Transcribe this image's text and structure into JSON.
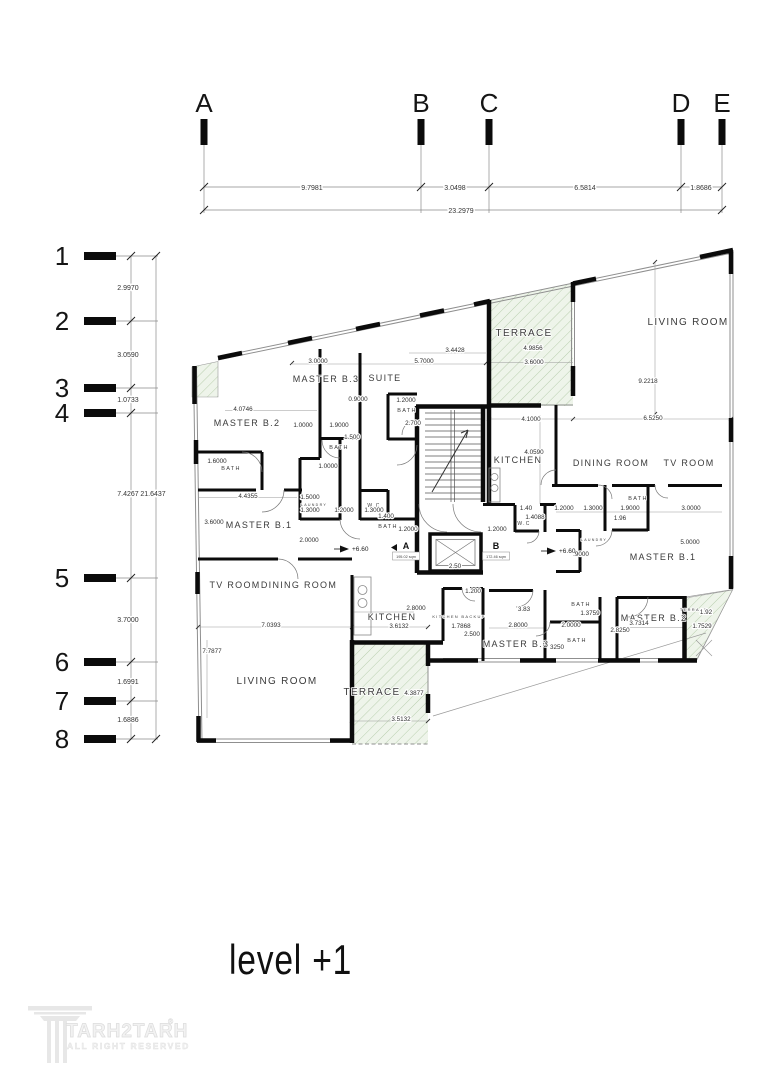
{
  "title": {
    "text": "level +1"
  },
  "logo": {
    "name": "TARH2TARH",
    "registered": "®",
    "tagline": "ALL RIGHT RESERVED"
  },
  "colors": {
    "wall": "#0b0b0b",
    "dim_text": "#2e2e2e",
    "hatch_fill": "#eef4ea",
    "hatch_line": "#b9cfae",
    "window_line": "#8f8f8f",
    "logo_gray": "#ececec"
  },
  "grid": {
    "top": {
      "columns": [
        {
          "label": "A",
          "x": 204
        },
        {
          "label": "B",
          "x": 421
        },
        {
          "label": "C",
          "x": 489
        },
        {
          "label": "D",
          "x": 681
        },
        {
          "label": "E",
          "x": 722
        }
      ],
      "segment_dims": [
        {
          "text": "9.7981",
          "x": 312
        },
        {
          "text": "3.0498",
          "x": 455
        },
        {
          "text": "6.5814",
          "x": 585
        },
        {
          "text": "1.8686",
          "x": 701
        }
      ],
      "overall_dim": {
        "text": "23.2979",
        "x": 461
      }
    },
    "left": {
      "rows": [
        {
          "label": "1",
          "y": 256
        },
        {
          "label": "2",
          "y": 321
        },
        {
          "label": "3",
          "y": 388
        },
        {
          "label": "4",
          "y": 413
        },
        {
          "label": "5",
          "y": 578
        },
        {
          "label": "6",
          "y": 662
        },
        {
          "label": "7",
          "y": 701
        },
        {
          "label": "8",
          "y": 739
        }
      ],
      "segment_dims": [
        {
          "text": "2.9970",
          "y": 288
        },
        {
          "text": "3.0590",
          "y": 355
        },
        {
          "text": "1.0733",
          "y": 400
        },
        {
          "text": "7.4267",
          "y": 494
        },
        {
          "text": "3.7000",
          "y": 620
        },
        {
          "text": "1.6991",
          "y": 682
        },
        {
          "text": "1.6886",
          "y": 720
        }
      ],
      "overall_dim": {
        "text": "21.6437",
        "y": 494
      }
    }
  },
  "plan": {
    "rooms": [
      {
        "name": "room-terrace-top",
        "text": "TERRACE",
        "x": 524,
        "y": 336,
        "fs": 10
      },
      {
        "name": "room-living-top-right",
        "text": "LIVING ROOM",
        "x": 688,
        "y": 325,
        "fs": 10
      },
      {
        "name": "room-master-b3-left",
        "text": "MASTER B.3",
        "x": 326,
        "y": 382,
        "fs": 9
      },
      {
        "name": "room-suite",
        "text": "SUITE",
        "x": 385,
        "y": 381,
        "fs": 9
      },
      {
        "name": "room-master-b2-left",
        "text": "MASTER B.2",
        "x": 247,
        "y": 426,
        "fs": 9
      },
      {
        "name": "room-bath-suite",
        "text": "BATH",
        "x": 407,
        "y": 412,
        "fs": 5.5
      },
      {
        "name": "room-bath-mid",
        "text": "BATH",
        "x": 339,
        "y": 449,
        "fs": 5.5
      },
      {
        "name": "room-bath-left",
        "text": "BATH",
        "x": 231,
        "y": 470,
        "fs": 5.5
      },
      {
        "name": "room-bath-core",
        "text": "BATH",
        "x": 388,
        "y": 528,
        "fs": 5.5
      },
      {
        "name": "room-master-b1-left",
        "text": "MASTER B.1",
        "x": 259,
        "y": 528,
        "fs": 9
      },
      {
        "name": "room-wc-left",
        "text": "W.C",
        "x": 374,
        "y": 507,
        "fs": 5
      },
      {
        "name": "room-laundry-left",
        "text": "LAUNDRY",
        "x": 314,
        "y": 506,
        "fs": 3.6
      },
      {
        "name": "room-kitchen-right",
        "text": "KITCHEN",
        "x": 518,
        "y": 463,
        "fs": 9
      },
      {
        "name": "room-dining-right",
        "text": "DINING ROOM",
        "x": 611,
        "y": 466,
        "fs": 9
      },
      {
        "name": "room-tv-right",
        "text": "TV ROOM",
        "x": 689,
        "y": 466,
        "fs": 9
      },
      {
        "name": "room-bath-right-top",
        "text": "BATH",
        "x": 638,
        "y": 500,
        "fs": 5.5
      },
      {
        "name": "room-wc-right",
        "text": "W.C",
        "x": 524,
        "y": 525,
        "fs": 5
      },
      {
        "name": "room-laundry-right",
        "text": "LAUNDRY",
        "x": 594,
        "y": 541,
        "fs": 3.6
      },
      {
        "name": "room-master-b1-right",
        "text": "MASTER B.1",
        "x": 663,
        "y": 560,
        "fs": 9
      },
      {
        "name": "room-tv-left",
        "text": "TV ROOM",
        "x": 235,
        "y": 588,
        "fs": 9
      },
      {
        "name": "room-dining-left",
        "text": "DINING ROOM",
        "x": 299,
        "y": 588,
        "fs": 9
      },
      {
        "name": "room-living-bottom-left",
        "text": "LIVING ROOM",
        "x": 277,
        "y": 684,
        "fs": 10
      },
      {
        "name": "room-kitchen-left",
        "text": "KITCHEN",
        "x": 392,
        "y": 620,
        "fs": 9
      },
      {
        "name": "room-kitchen-backup",
        "text": "KITCHEN BACKUP",
        "x": 459,
        "y": 618,
        "fs": 4
      },
      {
        "name": "room-master-b3-bottom",
        "text": "MASTER B.3",
        "x": 516,
        "y": 647,
        "fs": 9
      },
      {
        "name": "room-master-b2-bottom",
        "text": "MASTER B.2",
        "x": 654,
        "y": 621,
        "fs": 9
      },
      {
        "name": "room-bath-br-1",
        "text": "BATH",
        "x": 581,
        "y": 606,
        "fs": 5.5
      },
      {
        "name": "room-bath-br-2",
        "text": "BATH",
        "x": 577,
        "y": 642,
        "fs": 5.5
      },
      {
        "name": "room-terrace-bottom",
        "text": "TERRACE",
        "x": 372,
        "y": 695,
        "fs": 10
      },
      {
        "name": "room-terrace-br",
        "text": "TERRACE",
        "x": 694,
        "y": 611,
        "fs": 4
      }
    ],
    "dims": [
      {
        "text": "3.0000",
        "x": 318,
        "y": 363
      },
      {
        "text": "5.7000",
        "x": 424,
        "y": 363
      },
      {
        "text": "3.4428",
        "x": 455,
        "y": 352
      },
      {
        "text": "4.9856",
        "x": 533,
        "y": 350
      },
      {
        "text": "3.6000",
        "x": 534,
        "y": 364
      },
      {
        "text": "9.2218",
        "x": 648,
        "y": 383
      },
      {
        "text": "4.0746",
        "x": 243,
        "y": 411
      },
      {
        "text": "0.9000",
        "x": 358,
        "y": 401
      },
      {
        "text": "1.2000",
        "x": 406,
        "y": 402
      },
      {
        "text": "2.700",
        "x": 413,
        "y": 425
      },
      {
        "text": "4.1000",
        "x": 531,
        "y": 421
      },
      {
        "text": "6.5250",
        "x": 653,
        "y": 420
      },
      {
        "text": "4.0590",
        "x": 534,
        "y": 454
      },
      {
        "text": "1.0000",
        "x": 303,
        "y": 427
      },
      {
        "text": "1.9000",
        "x": 339,
        "y": 427
      },
      {
        "text": "1.500",
        "x": 352,
        "y": 439
      },
      {
        "text": "1.6000",
        "x": 217,
        "y": 463
      },
      {
        "text": "4.4355",
        "x": 248,
        "y": 498
      },
      {
        "text": "1.0000",
        "x": 328,
        "y": 468
      },
      {
        "text": "3.6000",
        "x": 214,
        "y": 524
      },
      {
        "text": "1.5000",
        "x": 310,
        "y": 499
      },
      {
        "text": "1.3000",
        "x": 310,
        "y": 512
      },
      {
        "text": "1.2000",
        "x": 344,
        "y": 512
      },
      {
        "text": "1.3000",
        "x": 374,
        "y": 512
      },
      {
        "text": "1.400",
        "x": 386,
        "y": 518
      },
      {
        "text": "2.0000",
        "x": 309,
        "y": 542
      },
      {
        "text": "1.2000",
        "x": 408,
        "y": 531
      },
      {
        "text": "1.2000",
        "x": 497,
        "y": 531
      },
      {
        "text": "1.40",
        "x": 526,
        "y": 510
      },
      {
        "text": "1.4088",
        "x": 535,
        "y": 519
      },
      {
        "text": "1.2000",
        "x": 564,
        "y": 510
      },
      {
        "text": "1.3000",
        "x": 593,
        "y": 510
      },
      {
        "text": "1.9000",
        "x": 630,
        "y": 510
      },
      {
        "text": "3.0000",
        "x": 691,
        "y": 510
      },
      {
        "text": "1.96",
        "x": 620,
        "y": 520
      },
      {
        "text": "5.0000",
        "x": 690,
        "y": 544
      },
      {
        "text": ".9000",
        "x": 581,
        "y": 556
      },
      {
        "text": "3.83",
        "x": 524,
        "y": 611
      },
      {
        "text": "2.8000",
        "x": 416,
        "y": 610
      },
      {
        "text": "2.8000",
        "x": 518,
        "y": 627
      },
      {
        "text": "1.200",
        "x": 473,
        "y": 593
      },
      {
        "text": "3.6132",
        "x": 399,
        "y": 628
      },
      {
        "text": "1.7868",
        "x": 461,
        "y": 628
      },
      {
        "text": "2.500",
        "x": 472,
        "y": 636
      },
      {
        "text": "7.0393",
        "x": 271,
        "y": 627
      },
      {
        "text": "7.7877",
        "x": 212,
        "y": 653
      },
      {
        "text": "4.3877",
        "x": 414,
        "y": 695
      },
      {
        "text": "3.5132",
        "x": 401,
        "y": 721
      },
      {
        "text": "1.3759",
        "x": 590,
        "y": 615
      },
      {
        "text": "2.0000",
        "x": 571,
        "y": 627
      },
      {
        "text": "3250",
        "x": 557,
        "y": 649
      },
      {
        "text": "3.7314",
        "x": 639,
        "y": 625
      },
      {
        "text": "2.8250",
        "x": 620,
        "y": 632
      },
      {
        "text": "1.92",
        "x": 706,
        "y": 614
      },
      {
        "text": "1.7529",
        "x": 702,
        "y": 628
      },
      {
        "text": "2.50",
        "x": 455,
        "y": 568,
        "fs": 4
      }
    ],
    "levels": [
      {
        "text": "+6.60",
        "x": 352,
        "y": 551
      },
      {
        "text": "+6.60",
        "x": 559,
        "y": 553
      }
    ],
    "units": [
      {
        "label": "A",
        "area": "195.02 sqm",
        "x": 406,
        "y": 549,
        "flag": true
      },
      {
        "label": "B",
        "area": "172.46 sqm",
        "x": 496,
        "y": 549,
        "flag": false
      }
    ]
  }
}
